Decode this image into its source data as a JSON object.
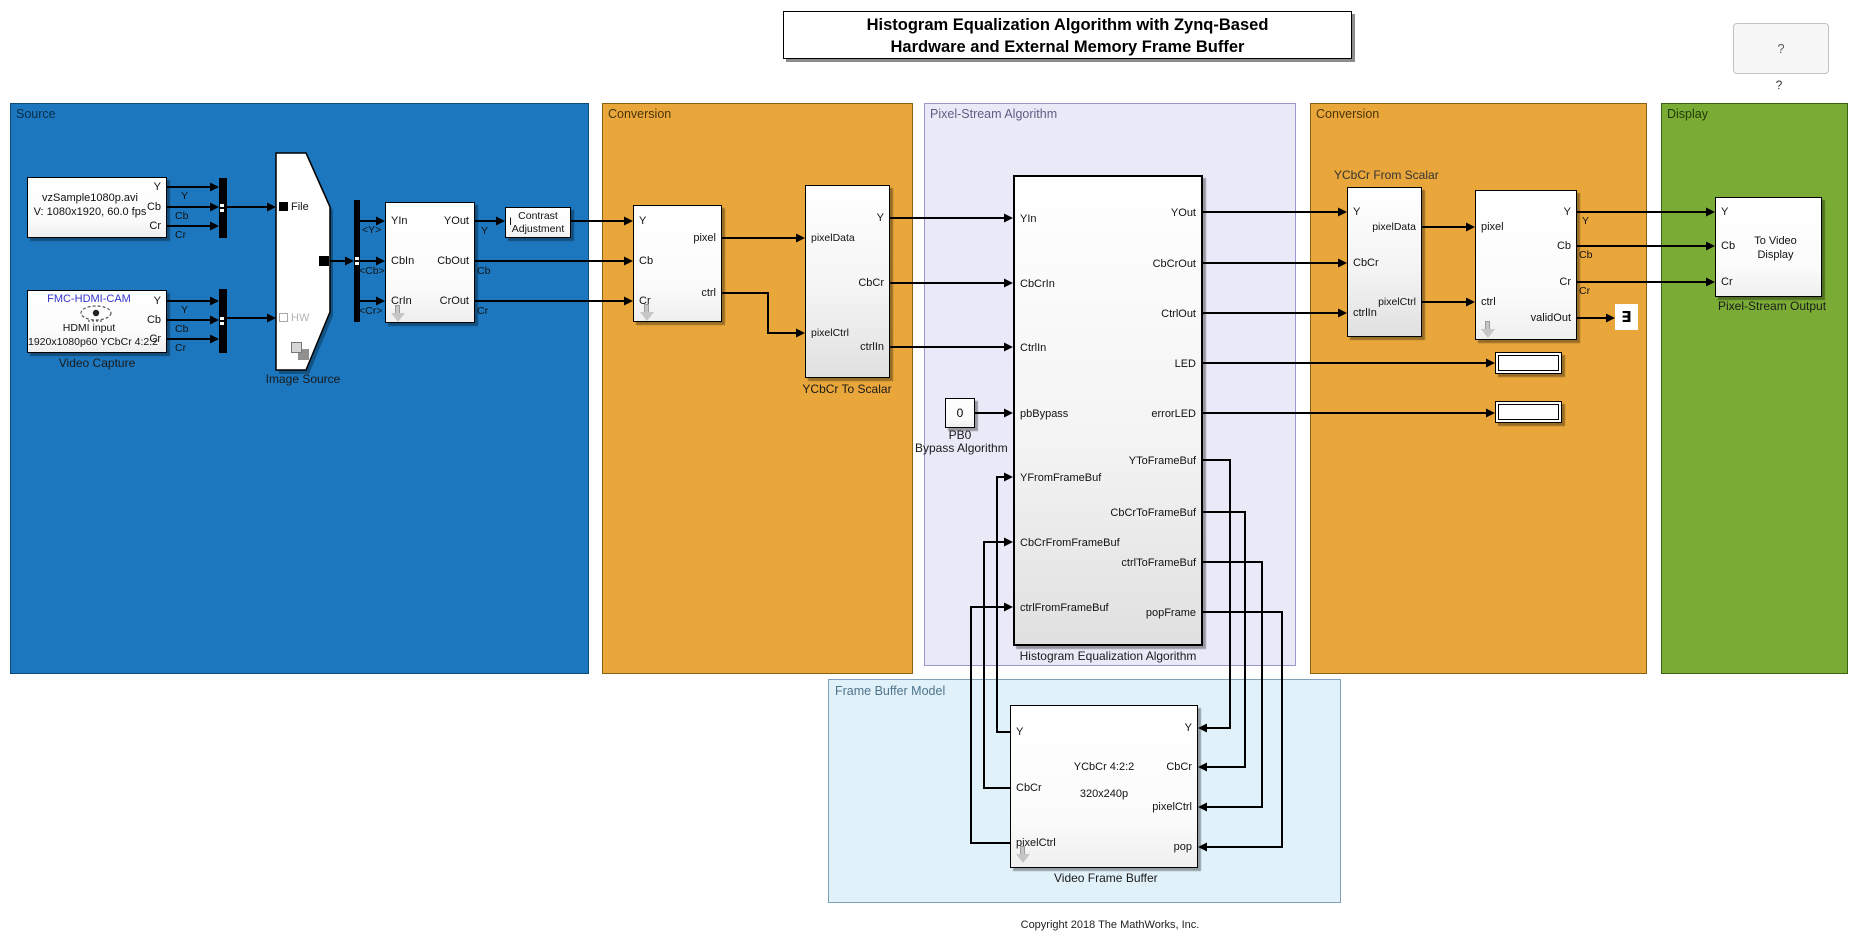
{
  "title": {
    "line1": "Histogram Equalization Algorithm with Zynq-Based",
    "line2": "Hardware and External Memory Frame Buffer"
  },
  "help": {
    "button": "?",
    "caption": "?"
  },
  "copyright": "Copyright 2018 The MathWorks, Inc.",
  "areas": {
    "source": "Source",
    "conversion1": "Conversion",
    "algorithm": "Pixel-Stream Algorithm",
    "conversion2": "Conversion",
    "display": "Display",
    "frame_buffer": "Frame Buffer Model"
  },
  "colors": {
    "source_fill": "#1C77BE",
    "conversion_fill": "#E9A63B",
    "algorithm_fill": "#E9E9F8",
    "display_fill": "#7AAC35",
    "frame_buffer_fill": "#E1F1FA"
  },
  "blocks": {
    "media_file": {
      "line1": "vzSample1080p.avi",
      "line2": "V: 1080x1920, 60.0 fps",
      "out": [
        "Y",
        "Cb",
        "Cr"
      ]
    },
    "video_capture": {
      "device": "FMC-HDMI-CAM",
      "line1": "HDMI input",
      "line2": "1920x1080p60 YCbCr 4:2:2",
      "caption": "Video Capture",
      "out": [
        "Y",
        "Cb",
        "Cr"
      ]
    },
    "image_source": {
      "port_file": "File",
      "port_hw": "HW",
      "caption": "Image Source"
    },
    "ycbcr422": {
      "in": [
        "YIn",
        "CbIn",
        "CrIn"
      ],
      "out": [
        "YOut",
        "CbOut",
        "CrOut"
      ]
    },
    "contrast": {
      "port_in": "I",
      "line1": "Contrast",
      "line2": "Adjustment"
    },
    "frame_to_pixels": {
      "in": [
        "Y",
        "Cb",
        "Cr"
      ],
      "out": [
        "pixel",
        "ctrl"
      ]
    },
    "ycbcr_to_scalar": {
      "caption": "YCbCr To Scalar",
      "in": [
        "pixelData",
        "pixelCtrl"
      ],
      "out": [
        "Y",
        "CbCr",
        "ctrlIn"
      ]
    },
    "pb0": {
      "value": "0",
      "caption1": "PB0",
      "caption2": "Bypass Algorithm"
    },
    "histeq": {
      "caption": "Histogram Equalization Algorithm",
      "in": [
        "YIn",
        "CbCrIn",
        "CtrlIn",
        "pbBypass",
        "YFromFrameBuf",
        "CbCrFromFrameBuf",
        "ctrlFromFrameBuf"
      ],
      "out": [
        "YOut",
        "CbCrOut",
        "CtrlOut",
        "LED",
        "errorLED",
        "YToFrameBuf",
        "CbCrToFrameBuf",
        "ctrlToFrameBuf",
        "popFrame"
      ]
    },
    "ycbcr_from_scalar": {
      "title": "YCbCr From Scalar",
      "in": [
        "Y",
        "CbCr",
        "ctrlIn"
      ],
      "out": [
        "pixelData",
        "pixelCtrl"
      ]
    },
    "pixels_to_frame": {
      "in": [
        "pixel",
        "ctrl"
      ],
      "out": [
        "Y",
        "Cb",
        "Cr",
        "validOut"
      ]
    },
    "terminator": {
      "glyph": "∃"
    },
    "to_video_display": {
      "line1": "To Video",
      "line2": "Display",
      "in": [
        "Y",
        "Cb",
        "Cr"
      ],
      "caption": "Pixel-Stream Output"
    },
    "video_frame_buffer": {
      "line1": "YCbCr 4:2:2",
      "line2": "320x240p",
      "left": [
        "Y",
        "CbCr",
        "pixelCtrl"
      ],
      "right": [
        "Y",
        "CbCr",
        "pixelCtrl",
        "pop"
      ],
      "caption": "Video Frame Buffer"
    }
  },
  "signal_labels": {
    "source1": [
      "Y",
      "Cb",
      "Cr"
    ],
    "source2": [
      "Y",
      "Cb",
      "Cr"
    ],
    "bus": [
      "<Y>",
      "<Cb>",
      "<Cr>"
    ],
    "ycbcr422_out": [
      "Y",
      "Cb",
      "Cr"
    ],
    "display_in": [
      "Y",
      "Cb",
      "Cr"
    ]
  }
}
